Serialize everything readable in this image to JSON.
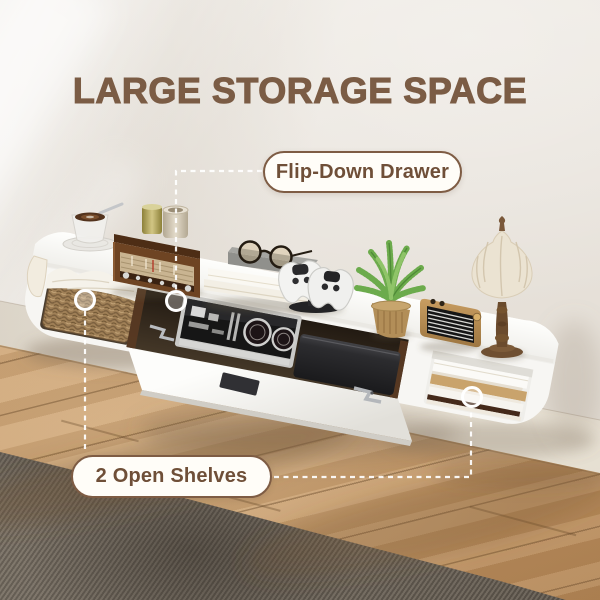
{
  "header": {
    "title": "LARGE STORAGE SPACE"
  },
  "callouts": {
    "drawer": {
      "label": "Flip-Down Drawer"
    },
    "shelves": {
      "label": "2 Open Shelves"
    }
  },
  "palette": {
    "title_text": "#7b5c45",
    "callout_text": "#6f4f38",
    "callout_border": "#7e5c44",
    "callout_bg": "#fffdf8",
    "callout_line": "#ffffff",
    "wall": "#e9e4dd",
    "baseboard": "#efeade",
    "floor_wood": "#c79f71",
    "rug": "#6e655b",
    "shelf_white": "#f7f6f3",
    "walnut_wood": "#6e4423"
  }
}
